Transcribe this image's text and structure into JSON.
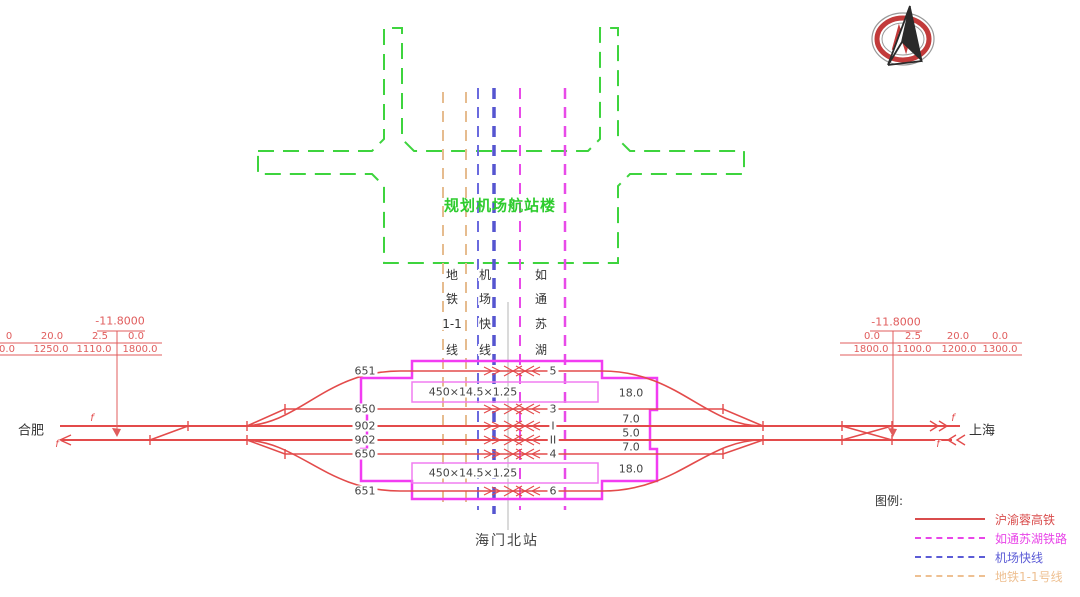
{
  "terminal": {
    "label": "规划机场航站楼"
  },
  "corridors": {
    "metro": {
      "label": "地铁1-1线",
      "segments": [
        "地",
        "铁",
        "1-1",
        "线"
      ]
    },
    "airport": {
      "label": "机场快线",
      "segments": [
        "机",
        "场",
        "快",
        "线"
      ]
    },
    "rutong": {
      "label": "如通苏湖",
      "segments": [
        "如",
        "通",
        "苏",
        "湖"
      ]
    }
  },
  "station": {
    "name": "海门北站",
    "left_city": "合肥",
    "right_city": "上海",
    "platform_label_top": "450×14.5×1.25",
    "platform_label_bottom": "450×14.5×1.25",
    "tracks": [
      {
        "length": "651",
        "num": "5"
      },
      {
        "length": "650",
        "num": "3"
      },
      {
        "length": "902",
        "num": "I"
      },
      {
        "length": "902",
        "num": "II"
      },
      {
        "length": "650",
        "num": "4"
      },
      {
        "length": "651",
        "num": "6"
      }
    ],
    "spacings": [
      "18.0",
      "7.0",
      "5.0",
      "7.0",
      "18.0"
    ],
    "f_mark": "f"
  },
  "dimensions": {
    "left": {
      "elevation": "-11.8000",
      "row1": [
        "0",
        "20.0",
        "2.5",
        "0.0"
      ],
      "row2": [
        "0.0",
        "1250.0",
        "1110.0",
        "1800.0"
      ]
    },
    "right": {
      "elevation": "-11.8000",
      "row1": [
        "0.0",
        "2.5",
        "20.0",
        "0.0"
      ],
      "row2": [
        "1800.0",
        "1100.0",
        "1200.0",
        "1300.0"
      ]
    }
  },
  "legend": {
    "title": "图例:",
    "items": [
      {
        "label": "沪渝蓉高铁",
        "color": "#d94c4c",
        "style": "solid"
      },
      {
        "label": "如通苏湖铁路",
        "color": "#e845e8",
        "style": "dashed"
      },
      {
        "label": "机场快线",
        "color": "#5b5bd6",
        "style": "dashed"
      },
      {
        "label": "地铁1-1号线",
        "color": "#eec092",
        "style": "dashed"
      }
    ]
  },
  "colors": {
    "hsr_red": "#e34b4b",
    "station_magenta": "#f23cf2",
    "airport_blue": "#5b5bd6",
    "metro_tan": "#e6bc8f",
    "terminal_green": "#3ed43e"
  }
}
